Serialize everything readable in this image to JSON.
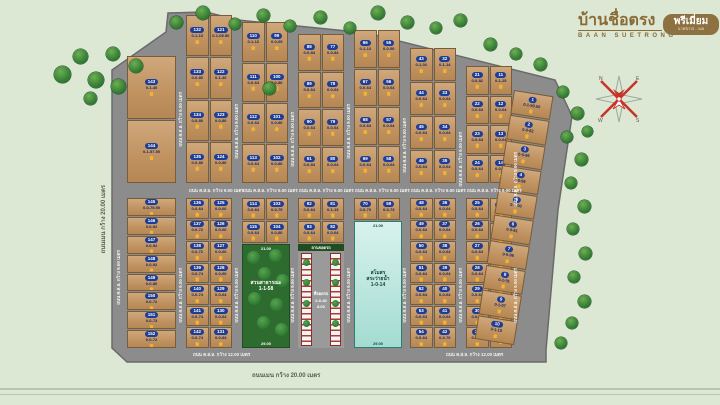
{
  "logo": {
    "title": "บ้านชื่อตรง",
    "subtitle": "BAAN SUETRONG",
    "badge": "พรีเมี่ยม",
    "badge_sub": "นาคนิวาส - 348"
  },
  "roads": {
    "concrete_9": "ถนน ค.ส.ล. กว้าง 9.00 เมตร",
    "concrete_12": "ถนน ค.ส.ล. กว้าง 12.00 เมตร",
    "main_20": "ถนนเมน กว้าง 20.00 เมตร"
  },
  "park": {
    "label1": "สวนสาธารณะ",
    "area": "1-1-58",
    "dim_top": "21.00",
    "dim_bottom": "29.00"
  },
  "club": {
    "label1": "สโมสร",
    "label2": "สระว่ายน้ำ",
    "area": "1-0-14",
    "dim_top": "21.00",
    "dim_bottom": "29.00"
  },
  "parking": {
    "header": "ลานจอดรถ",
    "label1": "ที่จอดรถ",
    "area": "0-0-40",
    "dim_bottom": "8.00"
  },
  "plan": {
    "wide_column": {
      "x": 127,
      "w": 49,
      "top": 56,
      "upper": [
        [
          "143",
          "0-1-40"
        ],
        [
          "144",
          "0-1-57.50"
        ]
      ],
      "lower": [
        [
          "145",
          "0-0-75.50"
        ],
        [
          "146",
          "0-0-92"
        ],
        [
          "147",
          "0-0-92"
        ],
        [
          "148",
          "0-0-92"
        ],
        [
          "149",
          "0-0-80"
        ],
        [
          "150",
          "0-0-72"
        ],
        [
          "151",
          "0-0-73"
        ],
        [
          "152",
          "0-0-72"
        ]
      ]
    },
    "groups": [
      {
        "x": 186,
        "top": 15,
        "feature": null,
        "cols": [
          {
            "upper": [
              [
                "132",
                "0-1-13"
              ],
              [
                "133",
                "0-0-80"
              ],
              [
                "134",
                "0-0-80"
              ],
              [
                "135",
                "0-0-80"
              ]
            ],
            "lower": [
              [
                "136",
                "0-0-64"
              ],
              [
                "137",
                "0-0-72"
              ],
              [
                "138",
                "0-0-72"
              ],
              [
                "139",
                "0-0-74"
              ],
              [
                "140",
                "0-0-74"
              ],
              [
                "141",
                "0-0-74"
              ],
              [
                "142",
                "0-0-74"
              ]
            ]
          },
          {
            "upper": [
              [
                "121",
                "0-1-05.50"
              ],
              [
                "122",
                "0-1-40"
              ],
              [
                "123",
                "0-0-80"
              ],
              [
                "124",
                "0-0-80"
              ]
            ],
            "lower": [
              [
                "125",
                "0-0-60"
              ],
              [
                "126",
                "0-0-60"
              ],
              [
                "127",
                "0-0-60"
              ],
              [
                "128",
                "0-0-60"
              ],
              [
                "129",
                "0-0-64"
              ],
              [
                "130",
                "0-0-64"
              ],
              [
                "131",
                "0-0-84"
              ]
            ]
          }
        ]
      },
      {
        "x": 242,
        "top": 22,
        "feature": "park",
        "cols": [
          {
            "upper": [
              [
                "110",
                "0-1-13"
              ],
              [
                "111",
                "0-0-64"
              ],
              [
                "112",
                "0-0-64"
              ],
              [
                "113",
                "0-0-64"
              ]
            ],
            "lower": [
              [
                "114",
                "0-0-64"
              ],
              [
                "115",
                "0-0-64"
              ]
            ]
          },
          {
            "upper": [
              [
                "99",
                "0-0-65"
              ],
              [
                "100",
                "0-0-80"
              ],
              [
                "101",
                "0-0-80"
              ],
              [
                "102",
                "0-0-80"
              ]
            ],
            "lower": [
              [
                "103",
                "0-0-75"
              ],
              [
                "104",
                "0-0-80"
              ]
            ]
          }
        ]
      },
      {
        "x": 298,
        "top": 34,
        "feature": "parking",
        "cols": [
          {
            "upper": [
              [
                "88",
                "0-0-84"
              ],
              [
                "89",
                "0-0-64"
              ],
              [
                "90",
                "0-0-64"
              ],
              [
                "91",
                "0-0-84"
              ]
            ],
            "lower": [
              [
                "92",
                "0-0-64"
              ],
              [
                "93",
                "0-0-64"
              ]
            ]
          },
          {
            "upper": [
              [
                "77",
                "0-0-84"
              ],
              [
                "78",
                "0-0-64"
              ],
              [
                "79",
                "0-0-64"
              ],
              [
                "80",
                "0-0-64"
              ]
            ],
            "lower": [
              [
                "81",
                "0-1-13"
              ],
              [
                "82",
                "0-0-64"
              ]
            ]
          }
        ]
      },
      {
        "x": 354,
        "top": 30,
        "feature": "club",
        "cols": [
          {
            "upper": [
              [
                "66",
                "0-1-13"
              ],
              [
                "67",
                "0-0-64"
              ],
              [
                "68",
                "0-0-64"
              ],
              [
                "69",
                "0-0-64"
              ]
            ],
            "lower": [
              [
                "70",
                "0-0-73"
              ]
            ]
          },
          {
            "upper": [
              [
                "55",
                "0-0-90"
              ],
              [
                "56",
                "0-0-64"
              ],
              [
                "57",
                "0-0-64"
              ],
              [
                "58",
                "0-0-64"
              ]
            ],
            "lower": [
              [
                "59",
                "0-0-73"
              ]
            ]
          }
        ]
      },
      {
        "x": 410,
        "top": 48,
        "feature": null,
        "cols": [
          {
            "upper": [
              [
                "43",
                "0-1-02"
              ],
              [
                "44",
                "0-0-64"
              ],
              [
                "45",
                "0-0-64"
              ],
              [
                "46",
                "0-0-64"
              ]
            ],
            "lower": [
              [
                "48",
                "0-0-64"
              ],
              [
                "49",
                "0-0-64"
              ],
              [
                "50",
                "0-0-64"
              ],
              [
                "51",
                "0-0-64"
              ],
              [
                "52",
                "0-0-64"
              ],
              [
                "53",
                "0-0-64"
              ],
              [
                "54",
                "0-0-64"
              ]
            ]
          },
          {
            "upper": [
              [
                "32",
                "0-1-14"
              ],
              [
                "33",
                "0-0-64"
              ],
              [
                "34",
                "0-0-64"
              ],
              [
                "35",
                "0-0-64"
              ]
            ],
            "lower": [
              [
                "36",
                "0-0-64"
              ],
              [
                "37",
                "0-0-64"
              ],
              [
                "38",
                "0-0-64"
              ],
              [
                "39",
                "0-0-64"
              ],
              [
                "40",
                "0-0-64"
              ],
              [
                "41",
                "0-0-64"
              ],
              [
                "42",
                "0-0-70"
              ]
            ]
          }
        ]
      },
      {
        "x": 466,
        "top": 66,
        "feature": null,
        "cols": [
          {
            "upper": [
              [
                "21",
                "0-0-82"
              ],
              [
                "22",
                "0-0-64"
              ],
              [
                "23",
                "0-0-64"
              ],
              [
                "24",
                "0-0-64"
              ]
            ],
            "lower": [
              [
                "25",
                "0-0-64"
              ],
              [
                "26",
                "0-0-64"
              ],
              [
                "27",
                "0-0-64"
              ],
              [
                "28",
                "0-0-64"
              ],
              [
                "29",
                "0-0-64"
              ],
              [
                "30",
                "0-0-64"
              ],
              [
                "31",
                "0-0-84"
              ]
            ]
          },
          {
            "upper": [
              [
                "11",
                "0-1-25"
              ],
              [
                "12",
                "0-0-64"
              ],
              [
                "13",
                "0-0-64"
              ],
              [
                "14",
                "0-0-64"
              ]
            ],
            "lower": [
              [
                "15",
                "0-0-64"
              ],
              [
                "16",
                "0-0-64"
              ],
              [
                "17",
                "0-0-64"
              ],
              [
                "18",
                "0-0-64"
              ],
              [
                "19",
                "0-0-64"
              ],
              [
                "20",
                "0-0-84"
              ]
            ]
          }
        ]
      }
    ],
    "slant_column": {
      "upper": [
        [
          "1",
          "0-1-50.50"
        ],
        [
          "2",
          "0-0-82"
        ],
        [
          "3",
          "0-0-96"
        ]
      ],
      "lower": [
        [
          "4",
          "0-0-96"
        ],
        [
          "5",
          "0-1-00"
        ],
        [
          "6",
          "0-0-81"
        ],
        [
          "7",
          "0-0-96"
        ],
        [
          "8",
          "0-1-01"
        ],
        [
          "9",
          "0-1-07"
        ],
        [
          "10",
          "0-1-10"
        ]
      ]
    },
    "trees": [
      [
        62,
        74,
        17
      ],
      [
        80,
        56,
        15
      ],
      [
        96,
        80,
        16
      ],
      [
        113,
        54,
        14
      ],
      [
        90,
        98,
        13
      ],
      [
        118,
        86,
        15
      ],
      [
        136,
        66,
        14
      ],
      [
        176,
        22,
        13
      ],
      [
        203,
        13,
        14
      ],
      [
        235,
        24,
        12
      ],
      [
        263,
        15,
        13
      ],
      [
        290,
        26,
        12
      ],
      [
        320,
        17,
        13
      ],
      [
        350,
        28,
        12
      ],
      [
        378,
        13,
        14
      ],
      [
        407,
        22,
        13
      ],
      [
        436,
        28,
        12
      ],
      [
        460,
        20,
        13
      ],
      [
        490,
        44,
        13
      ],
      [
        516,
        54,
        12
      ],
      [
        540,
        64,
        13
      ],
      [
        563,
        92,
        12
      ],
      [
        577,
        113,
        13
      ],
      [
        567,
        137,
        12
      ],
      [
        581,
        159,
        13
      ],
      [
        571,
        183,
        12
      ],
      [
        584,
        206,
        13
      ],
      [
        573,
        229,
        12
      ],
      [
        585,
        253,
        13
      ],
      [
        574,
        277,
        12
      ],
      [
        584,
        301,
        13
      ],
      [
        572,
        323,
        12
      ],
      [
        561,
        343,
        12
      ],
      [
        269,
        88,
        13
      ],
      [
        587,
        131,
        11
      ]
    ],
    "road_labels_vertical_y": [
      [
        181,
        92
      ],
      [
        237,
        104
      ],
      [
        293,
        112
      ],
      [
        349,
        104
      ],
      [
        405,
        118
      ],
      [
        461,
        132
      ],
      [
        516,
        152
      ],
      [
        119,
        250
      ],
      [
        181,
        268
      ],
      [
        237,
        268
      ],
      [
        293,
        268
      ],
      [
        349,
        268
      ],
      [
        405,
        268
      ],
      [
        461,
        268
      ],
      [
        516,
        268
      ]
    ],
    "mid_road_label_x": [
      211,
      265,
      321,
      377,
      433,
      489
    ],
    "bottom_road_label_x": [
      215,
      468
    ]
  }
}
